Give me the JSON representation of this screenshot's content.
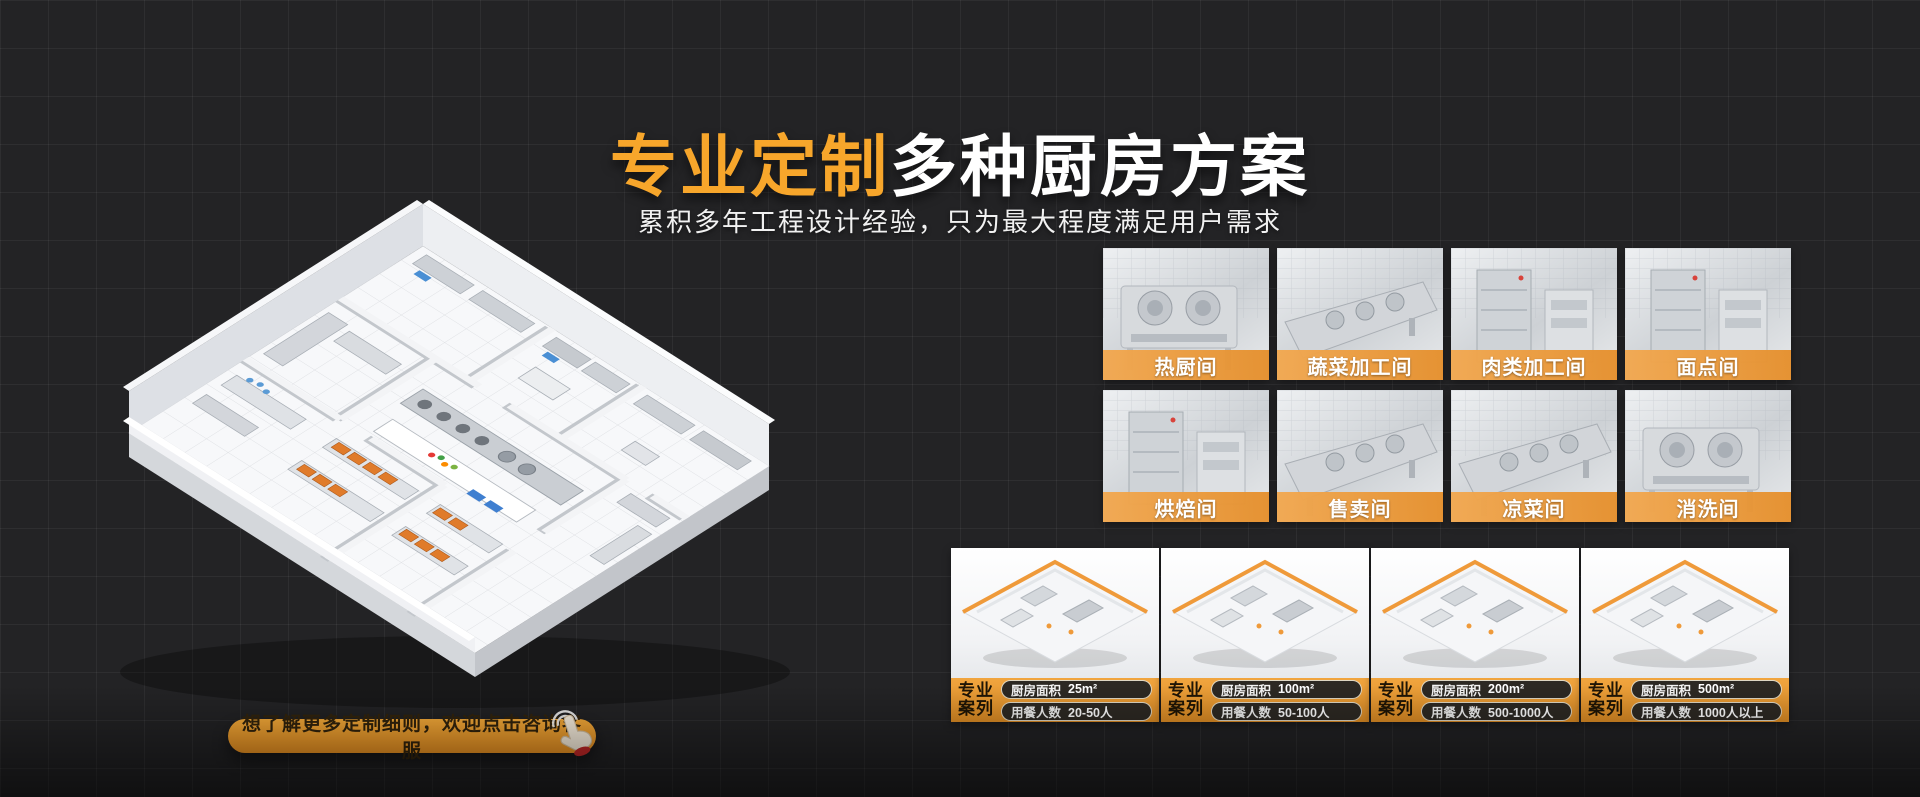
{
  "page": {
    "background_color": "#232325",
    "grid_line_color": "#2D2E31",
    "accent_color": "#F7A62B"
  },
  "hero": {
    "title_highlight": "专业定制",
    "title_rest": "多种厨房方案",
    "subtitle": "累积多年工程设计经验，只为最大程度满足用户需求"
  },
  "cta": {
    "label": "想了解更多定制细则，欢迎点击咨询客服",
    "icon": "tap-hand-icon",
    "background_color": "#F39A2B",
    "text_color": "#33240C"
  },
  "rooms": {
    "label_bar_color": "#EC9C3B",
    "items": [
      {
        "label": "热厨间"
      },
      {
        "label": "蔬菜加工间"
      },
      {
        "label": "肉类加工间"
      },
      {
        "label": "面点间"
      },
      {
        "label": "烘焙间"
      },
      {
        "label": "售卖间"
      },
      {
        "label": "凉菜间"
      },
      {
        "label": "消洗间"
      }
    ]
  },
  "cases": {
    "badge_line1": "专业",
    "badge_line2": "案列",
    "area_label": "厨房面积",
    "diners_label": "用餐人数",
    "footer_color": "#EC9C3B",
    "pill_color": "#2D2923",
    "items": [
      {
        "area": "25m²",
        "diners": "20-50人"
      },
      {
        "area": "100m²",
        "diners": "50-100人"
      },
      {
        "area": "200m²",
        "diners": "500-1000人"
      },
      {
        "area": "500m²",
        "diners": "1000人以上"
      }
    ]
  }
}
